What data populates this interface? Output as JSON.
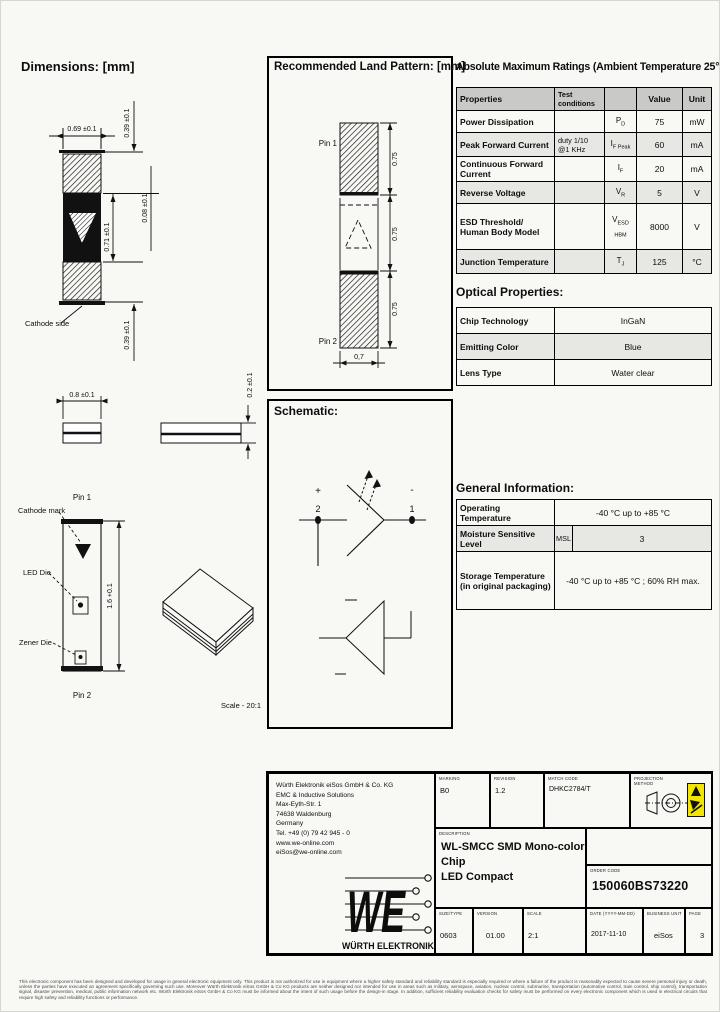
{
  "dims": {
    "title": "Dimensions: [mm]",
    "front": {
      "w": "0.69 ±0.1",
      "pad_top": "0.39 ±0.1",
      "gap": "0.08 ±0.1",
      "body": "0.71 ±0.1",
      "pad_bot": "0.39 ±0.1",
      "cathode": "Cathode side"
    },
    "side": {
      "w": "0.8 ±0.1",
      "t": "0.2 ±0.1"
    },
    "die": {
      "pin1": "Pin 1",
      "pin2": "Pin 2",
      "cathode_mark": "Cathode mark",
      "led_die": "LED Die",
      "zener_die": "Zener Die",
      "len": "1.6 +0.1"
    },
    "scale": "Scale - 20:1"
  },
  "land": {
    "title": "Recommended Land Pattern: [mm]",
    "pin1": "Pin 1",
    "pin2": "Pin 2",
    "d1": "0.75",
    "d2": "0.75",
    "d3": "0.75",
    "w": "0,7"
  },
  "schematic": {
    "title": "Schematic:",
    "plus": "+",
    "minus": "-",
    "n2": "2",
    "n1": "1"
  },
  "ratings": {
    "title": "Absolute Maximum Ratings (Ambient Temperature 25°C):",
    "h": {
      "p": "Properties",
      "tc": "Test conditions",
      "v": "Value",
      "u": "Unit"
    },
    "rows": [
      {
        "p": "Power Dissipation",
        "tc": "",
        "sym": "P",
        "sub": "D",
        "v": "75",
        "u": "mW"
      },
      {
        "p": "Peak Forward Current",
        "tc": "duty 1/10 @1 KHz",
        "sym": "I",
        "sub": "F Peak",
        "v": "60",
        "u": "mA"
      },
      {
        "p": "Continuous Forward Current",
        "tc": "",
        "sym": "I",
        "sub": "F",
        "v": "20",
        "u": "mA"
      },
      {
        "p": "Reverse Voltage",
        "tc": "",
        "sym": "V",
        "sub": "R",
        "v": "5",
        "u": "V"
      },
      {
        "p": "ESD Threshold/ Human Body Model",
        "tc": "",
        "sym": "V",
        "sub": "ESD HBM",
        "v": "8000",
        "u": "V"
      },
      {
        "p": "Junction Temperature",
        "tc": "",
        "sym": "T",
        "sub": "J",
        "v": "125",
        "u": "°C"
      }
    ]
  },
  "optical": {
    "title": "Optical Properties:",
    "rows": [
      {
        "k": "Chip Technology",
        "v": "InGaN"
      },
      {
        "k": "Emitting Color",
        "v": "Blue"
      },
      {
        "k": "Lens Type",
        "v": "Water clear"
      }
    ]
  },
  "general": {
    "title": "General Information:",
    "r1k": "Operating Temperature",
    "r1v": "-40 °C up to +85 °C",
    "r2k": "Moisture Sensitive Level",
    "r2m": "MSL",
    "r2v": "3",
    "r3k": "Storage Temperature (in original packaging)",
    "r3v": "-40 °C up to +85 °C ; 60% RH max."
  },
  "tb": {
    "company": [
      "Würth Elektronik eiSos GmbH & Co. KG",
      "EMC & Inductive Solutions",
      "",
      "Max-Eyth-Str. 1",
      "74638 Waldenburg",
      "Germany",
      "Tel. +49 (0) 79 42 945 - 0",
      "",
      "www.we-online.com",
      "eiSos@we-online.com"
    ],
    "logo_we": "WE",
    "logo_name": "WÜRTH ELEKTRONIK",
    "marking_label": "MARKING",
    "marking": "B0",
    "revision_label": "REVISION",
    "revision": "1.2",
    "match_label": "MATCH CODE",
    "match": "DHKC2784/T",
    "projection_label": "PROJECTION METHOD",
    "description_label": "DESCRIPTION",
    "description_line1": "WL-SMCC SMD Mono-color Chip",
    "description_line2": "LED Compact",
    "order_label": "ORDER CODE",
    "order": "150060BS73220",
    "size_label": "SIZE/TYPE",
    "size": "0603",
    "version_label": "VERSION",
    "version": "01.00",
    "scale_label": "SCALE",
    "scale": "2:1",
    "date_label": "DATE (YYYY-MM-DD)",
    "date": "2017-11-10",
    "bu_label": "BUSINESS UNIT",
    "bu": "eiSos",
    "page_label": "PAGE",
    "page": "3"
  },
  "colors": {
    "brand_red": "#e30613",
    "esd_yellow": "#f2e600"
  },
  "disclaimer": "This electronic component has been designed and developed for usage in general electronic equipment only. This product is not authorized for use in equipment where a higher safety standard and reliability standard is especially required or where a failure of the product is reasonably expected to cause severe personal injury or death, unless the parties have executed an agreement specifically governing such use. Moreover Würth Elektronik eiSos GmbH & Co KG products are neither designed nor intended for use in areas such as military, aerospace, aviation, nuclear control, submarine, transportation (automotive control, train control, ship control), transportation signal, disaster prevention, medical, public information network etc. Würth Elektronik eiSos GmbH & Co KG must be informed about the intent of such usage before the design-in stage. In addition, sufficient reliability evaluation checks for safety must be performed on every electronic component which is used in electrical circuits that require high safety and reliability functions or performance."
}
